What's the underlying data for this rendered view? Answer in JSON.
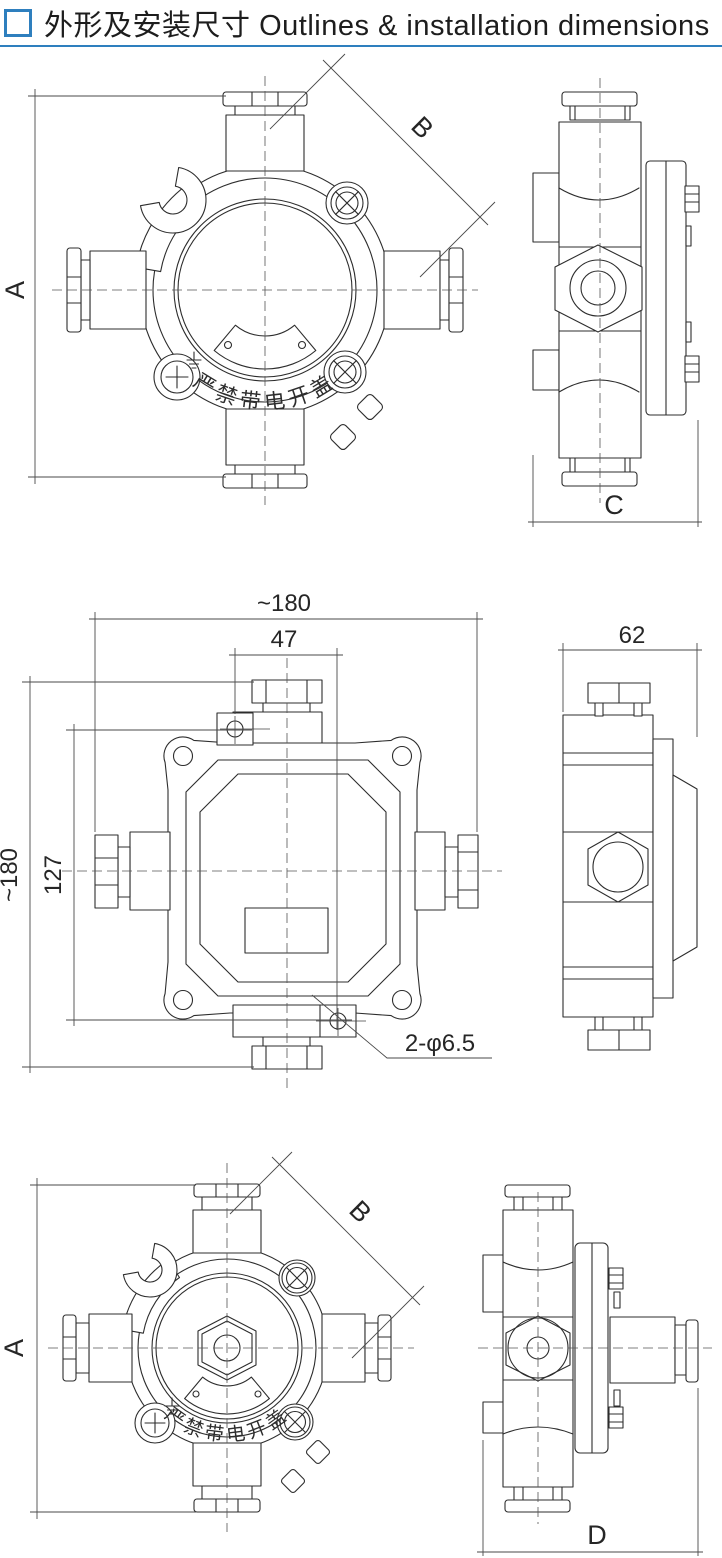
{
  "header": {
    "bullet_icon": "square-outline",
    "title_zh": "外形及安装尺寸",
    "title_en": "Outlines & installation dimensions",
    "accent_color": "#2e7fbe"
  },
  "drawing": {
    "warning_text": "严禁带电开盖",
    "views": {
      "round_box_front_top": {
        "label_height": "A",
        "label_diagonal": "B"
      },
      "round_box_side_top": {
        "label_width": "C"
      },
      "square_box_front": {
        "label_overall_width": "~180",
        "label_hole_offset": "47",
        "label_hole_spacing": "127",
        "label_overall_height": "~180",
        "label_mounting_holes": "2-φ6.5"
      },
      "square_box_side": {
        "label_width": "62"
      },
      "round_box_front_bottom": {
        "label_height": "A",
        "label_diagonal": "B"
      },
      "round_box_side_bottom": {
        "label_width": "D"
      }
    }
  }
}
